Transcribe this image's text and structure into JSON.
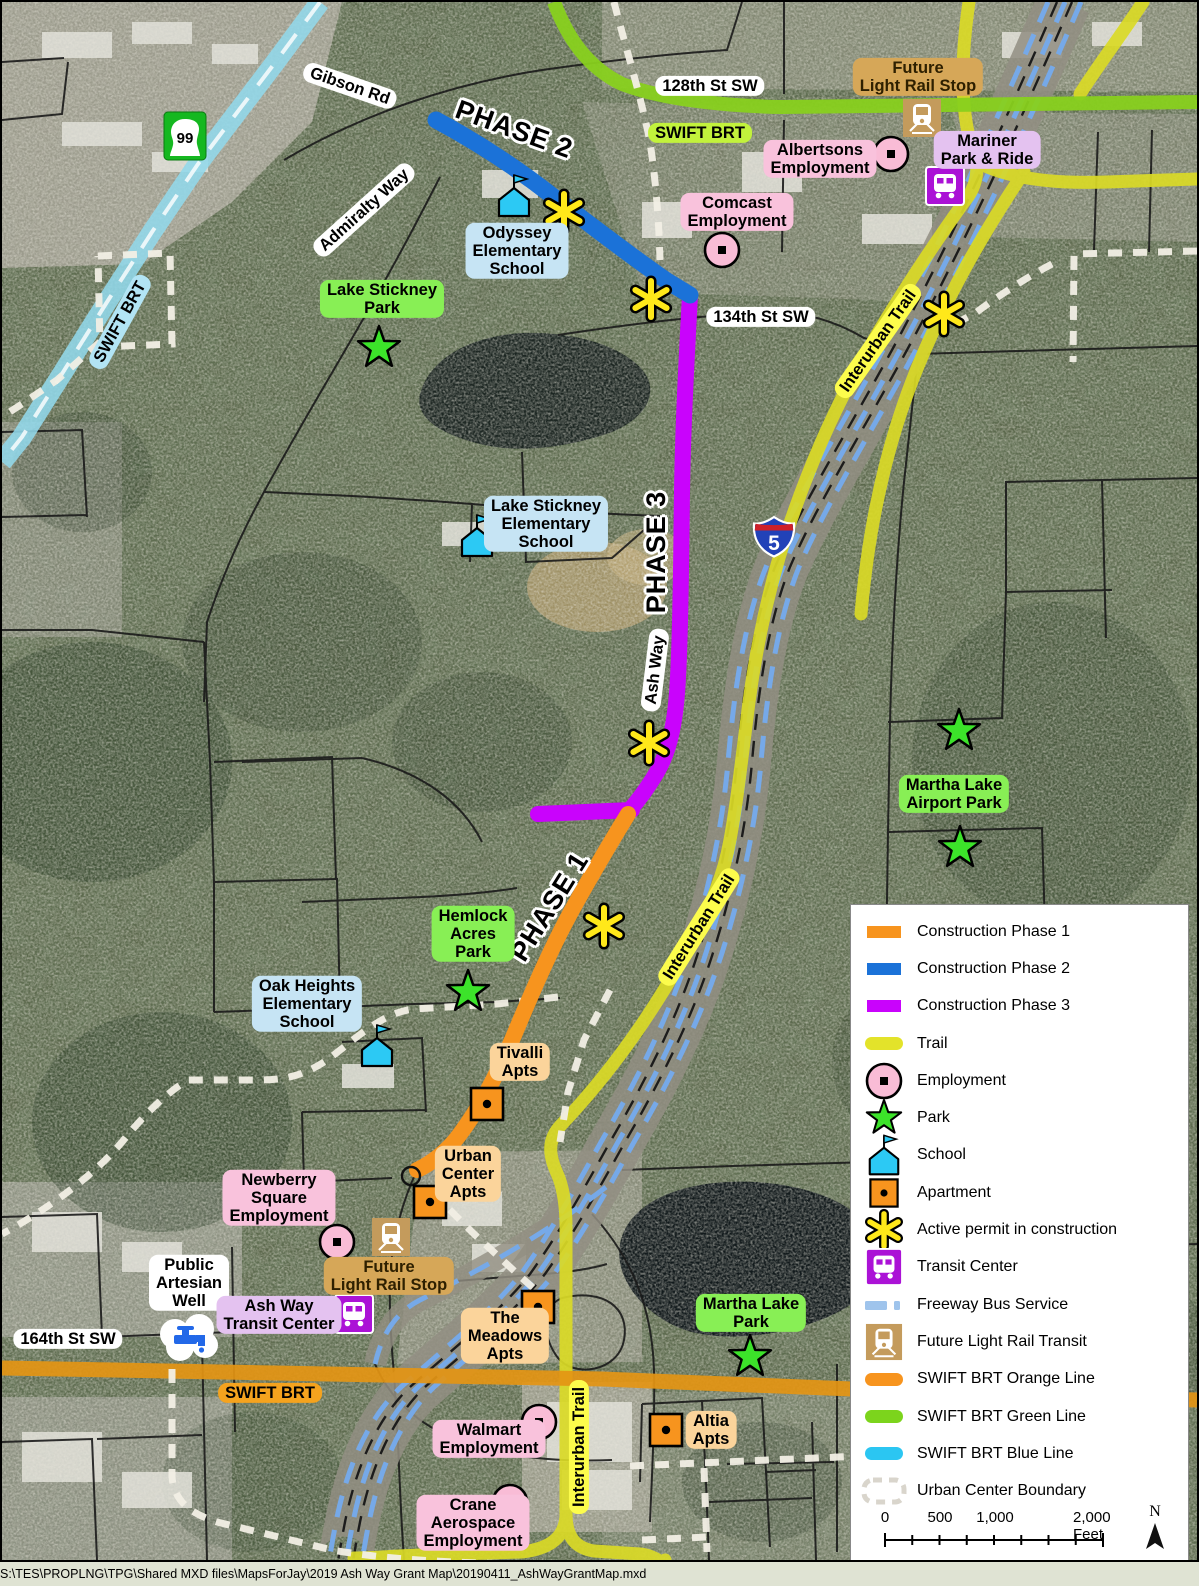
{
  "map": {
    "streets": {
      "gibson_rd": "Gibson Rd",
      "st_128": "128th St SW",
      "admiralty_way": "Admiralty Way",
      "st_134": "134th St SW",
      "ash_way": "Ash Way",
      "st_164": "164th St SW"
    },
    "phase_labels": {
      "phase1": "PHASE 1",
      "phase2": "PHASE 2",
      "phase3": "PHASE 3"
    },
    "route_labels": {
      "swift_brt_green": "SWIFT BRT",
      "swift_brt_blue": "SWIFT BRT",
      "swift_brt_orange": "SWIFT BRT",
      "interurban_trail_north": "Interurban Trail",
      "interurban_trail_mid": "Interurban Trail",
      "interurban_trail_south": "Interurban Trail",
      "i5": "5",
      "sr99": "99"
    },
    "places": {
      "future_light_rail_stop_north": "Future\nLight Rail Stop",
      "mariner_park_and_ride": "Mariner\nPark & Ride",
      "albertsons_employment": "Albertsons\nEmployment",
      "comcast_employment": "Comcast\nEmployment",
      "odyssey_elementary": "Odyssey\nElementary\nSchool",
      "lake_stickney_park": "Lake Stickney\nPark",
      "lake_stickney_elementary": "Lake Stickney\nElementary\nSchool",
      "martha_lake_airport_park": "Martha Lake\nAirport Park",
      "hemlock_acres_park": "Hemlock\nAcres\nPark",
      "oak_heights_elementary": "Oak Heights\nElementary\nSchool",
      "tivalli_apts": "Tivalli\nApts",
      "urban_center_apts": "Urban\nCenter\nApts",
      "newberry_square_employment": "Newberry\nSquare\nEmployment",
      "public_artesian_well": "Public\nArtesian\nWell",
      "ash_way_transit_center": "Ash Way\nTransit Center",
      "future_light_rail_stop_south": "Future\nLight Rail Stop",
      "the_meadows_apts": "The\nMeadows\nApts",
      "martha_lake_park": "Martha Lake\nPark",
      "walmart_employment": "Walmart\nEmployment",
      "altia_apts": "Altia\nApts",
      "crane_aerospace_employment": "Crane\nAerospace\nEmployment"
    }
  },
  "legend": {
    "items": [
      {
        "icon": "phase1-line",
        "label": "Construction Phase 1"
      },
      {
        "icon": "phase2-line",
        "label": "Construction Phase 2"
      },
      {
        "icon": "phase3-line",
        "label": "Construction Phase 3"
      },
      {
        "icon": "trail-line",
        "label": "Trail"
      },
      {
        "icon": "employment-marker",
        "label": "Employment"
      },
      {
        "icon": "park-marker",
        "label": "Park"
      },
      {
        "icon": "school-marker",
        "label": "School"
      },
      {
        "icon": "apartment-marker",
        "label": "Apartment"
      },
      {
        "icon": "active-permit-marker",
        "label": "Active permit in construction"
      },
      {
        "icon": "transit-center-marker",
        "label": "Transit Center"
      },
      {
        "icon": "freeway-bus-line",
        "label": "Freeway Bus Service"
      },
      {
        "icon": "light-rail-marker",
        "label": "Future Light Rail Transit"
      },
      {
        "icon": "swift-orange-line",
        "label": "SWIFT BRT Orange Line"
      },
      {
        "icon": "swift-green-line",
        "label": "SWIFT BRT Green Line"
      },
      {
        "icon": "swift-blue-line",
        "label": "SWIFT BRT Blue Line"
      },
      {
        "icon": "urban-boundary-line",
        "label": "Urban Center Boundary"
      }
    ],
    "scale_bar": {
      "t0": "0",
      "t1": "500",
      "t2": "1,000",
      "t3": "2,000 Feet"
    },
    "north_label": "N"
  },
  "footer": {
    "document_path": "S:\\TES\\PROPLNG\\TPG\\Shared MXD files\\MapsForJay\\2019 Ash Way Grant Map\\20190411_AshWayGrantMap.mxd"
  },
  "colors": {
    "phase1": "#F7941E",
    "phase2": "#1B72D8",
    "phase3": "#C903FC",
    "trail": "#DADA26",
    "swift_orange": "#E49514",
    "swift_green": "#88D01E",
    "swift_blue": "#92D8EA",
    "employment": "#F9BCD6",
    "park": "#3CE32A",
    "school": "#2CC9F4",
    "apartment": "#F7941E",
    "transit_center": "#AB12D6",
    "light_rail": "#C49B5C",
    "freeway_bus": "#76A9E8",
    "urban_boundary": "#F2EFE5"
  }
}
